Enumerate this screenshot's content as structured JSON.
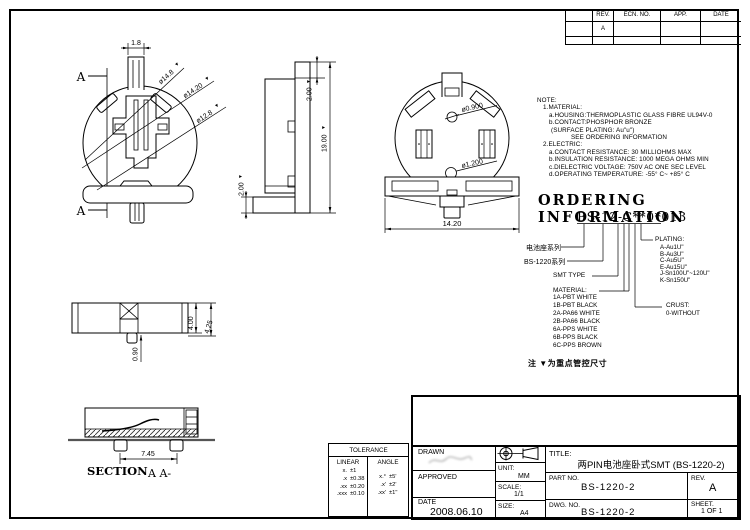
{
  "revision_table": {
    "col_rev": "REV.",
    "col_ecn": "ECN. NO.",
    "col_app": "APP.",
    "col_date": "DATE",
    "row1_rev": "A"
  },
  "marks": {
    "key": "▼"
  },
  "front_view": {
    "a_top": "A",
    "a_bottom": "A",
    "dim_width": "1.8",
    "dia_outer": "ø14.8",
    "dia_mid": "ø14.20",
    "dia_inner": "ø12.8"
  },
  "side_view": {
    "dim_top": "2.00",
    "dim_overall": "19.00",
    "dim_bottom": "2.00"
  },
  "back_view": {
    "hole_small": "ø0.900",
    "hole_large": "ø1.200",
    "dim_width": "14.20"
  },
  "top_view": {
    "dim_h": "4.00",
    "dim_h2": "4.25",
    "dim_pin": "0.90"
  },
  "section_view": {
    "dim_pitch": "7.45",
    "label": "SECTION",
    "label2": "A A-"
  },
  "notes": {
    "title": "NOTE:",
    "l1": "1.MATERIAL:",
    "l2": "a.HOUSING:THERMOPLASTIC GLASS FIBRE UL94V-0",
    "l3": "b.CONTACT:PHOSPHOR BRONZE",
    "l4": "(SURFACE PLATING: Au\"u\")",
    "l5": "SEE ORDERING INFORMATION",
    "l6": "2.ELECTRIC:",
    "l7": "a.CONTACT RESISTANCE: 30 MILLIOHMS MAX",
    "l8": "b.INSULATION RESISTANCE: 1000 MEGA OHMS MIN",
    "l9": "c.DIELECTRIC VOLTAGE: 750V AC ONE SEC LEVEL",
    "l10": "d.OPERATING TEMPERATURE: -55° C~ +85° C"
  },
  "ordering": {
    "title": "ORDERING INFORMATION",
    "code": "BS-12-C**0*013",
    "series_label": "电池座系列",
    "family_label": "BS-1220系列",
    "smt_label": "SMT TYPE",
    "material_label": "MATERIAL:",
    "materials": [
      "1A-PBT WHITE",
      "1B-PBT BLACK",
      "2A-PA66 WHITE",
      "2B-PA66 BLACK",
      "6A-PPS WHITE",
      "6B-PPS BLACK",
      "6C-PPS BROWN"
    ],
    "plating_label": "PLATING:",
    "platings": [
      "A-Au1U\"",
      "B-Au3U\"",
      "C-Au5U\"",
      "E-Au15U\"",
      "J-Sn100U\"~120U\"",
      "K-Sn150U\""
    ],
    "crust_label": "CRUST:",
    "crust_value": "0-WITHOUT"
  },
  "key_note": "注 ▼为重点管控尺寸",
  "tolerance": {
    "title": "TOLERANCE",
    "linear": "LINEAR",
    "angle": "ANGLE",
    "linear_rows": [
      {
        "s": "x.",
        "v": "±1"
      },
      {
        "s": ".x",
        "v": "±0.38"
      },
      {
        "s": ".xx",
        "v": "±0.20"
      },
      {
        "s": ".xxx",
        "v": "±0.10"
      }
    ],
    "angle_rows": [
      {
        "s": "x.°",
        "v": "±5'"
      },
      {
        "s": ".x'",
        "v": "±2'"
      },
      {
        "s": ".xx'",
        "v": "±1\""
      }
    ]
  },
  "title_block": {
    "drawn": "DRAWN",
    "approved": "APPROVED",
    "date": "DATE",
    "date_value": "2008.06.10",
    "unit": "UNIT:",
    "unit_value": "MM",
    "scale": "SCALE:",
    "scale_value": "1/1",
    "size": "SIZE:",
    "size_value": "A4",
    "title": "TITLE:",
    "title_value": "两PIN电池座卧式SMT (BS-1220-2)",
    "part_no": "PART NO.",
    "part_no_value": "BS-1220-2",
    "dwg_no": "DWG. NO.",
    "dwg_no_value": "BS-1220-2",
    "rev": "REV.",
    "rev_value": "A",
    "sheet": "SHEET.",
    "sheet_value": "1 OF 1"
  }
}
